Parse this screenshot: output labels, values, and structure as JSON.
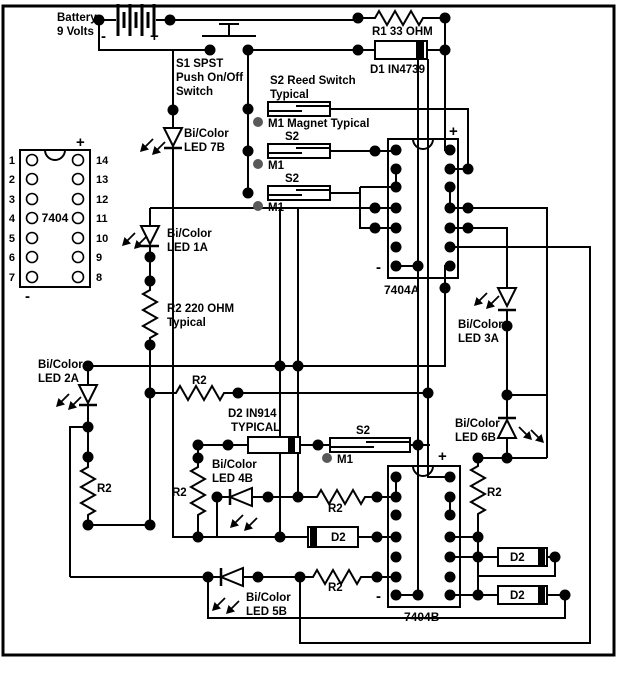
{
  "diagram": {
    "power": {
      "battery_line1": "Battery",
      "battery_line2": "9 Volts",
      "minus": "-",
      "plus": "+"
    },
    "switch_s1": {
      "line1": "S1 SPST",
      "line2": "Push On/Off",
      "line3": "Switch"
    },
    "r1_label": "R1 33 OHM",
    "d1_label": "D1 IN4739",
    "reed": {
      "line1": "S2 Reed Switch",
      "line2": "Typical",
      "s2": "S2",
      "m1": "M1",
      "m1_typical": "M1 Magnet Typical"
    },
    "r2": {
      "generic": "R2",
      "typ_line1": "R2 220 OHM",
      "typ_line2": "Typical"
    },
    "d2": {
      "generic": "D2",
      "typ_line1": "D2 IN914",
      "typ_line2": "TYPICAL"
    },
    "ic": {
      "pinout_name": "7404",
      "a_name": "7404A",
      "b_name": "7404B",
      "plus": "+",
      "minus": "-",
      "pins_left": [
        "1",
        "2",
        "3",
        "4",
        "5",
        "6",
        "7"
      ],
      "pins_right": [
        "14",
        "13",
        "12",
        "11",
        "10",
        "9",
        "8"
      ]
    },
    "leds": {
      "bicolor": "Bi/Color",
      "l1a": "LED 1A",
      "l2a": "LED 2A",
      "l3a": "LED 3A",
      "l4b": "LED 4B",
      "l5b": "LED 5B",
      "l6b": "LED 6B",
      "l7b": "LED 7B"
    },
    "colors": {
      "wire": "#000000",
      "magnet": "#595959",
      "background": "#ffffff"
    }
  }
}
